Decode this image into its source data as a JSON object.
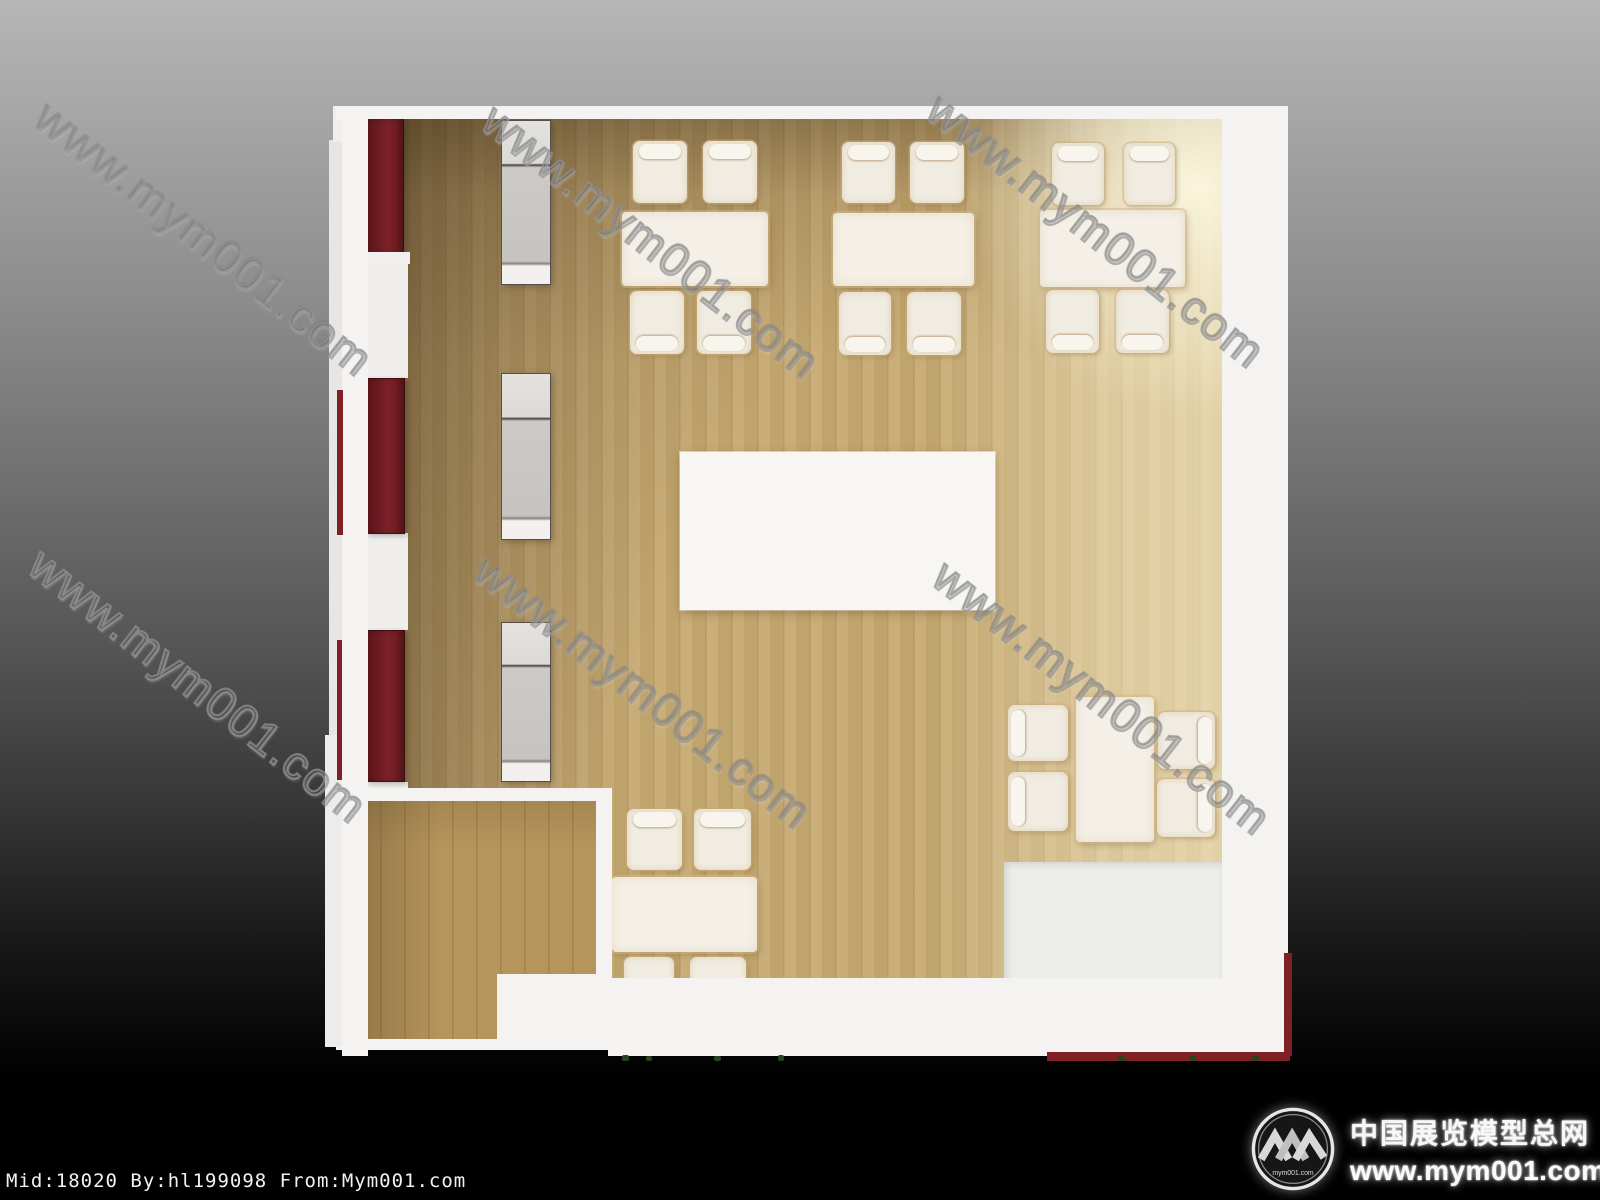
{
  "scene": {
    "colors": {
      "background_top": "#b6b6b6",
      "background_bottom": "#000000",
      "wall_white": "#f4f3f1",
      "floor_wood": "#c6aa72",
      "floor_wood_dark": "#7a5f3e",
      "floor_wood_light": "#ecd9a4",
      "small_room_floor": "#b5955c",
      "cabinet_red": "#7b2127",
      "display_case_gray": "#c9c7c3",
      "furniture_white": "#f1ece2",
      "platform_gray": "#ececea",
      "watermark_gray": "#949494"
    }
  },
  "watermark": {
    "text": "www.mym001.com",
    "angle_deg": 38,
    "positions": [
      {
        "x": 58,
        "y": 90
      },
      {
        "x": 505,
        "y": 93
      },
      {
        "x": 950,
        "y": 82
      },
      {
        "x": 52,
        "y": 537
      },
      {
        "x": 497,
        "y": 543
      },
      {
        "x": 956,
        "y": 549
      }
    ]
  },
  "branding": {
    "logo_badge_text": "mym001.com",
    "site_name_cn": "中国展览模型总网",
    "site_url": "www.mym001.com"
  },
  "footer": {
    "credit": "Mid:18020 By:hl199098 From:Mym001.com"
  },
  "floorplan": {
    "floor": {
      "x": 367,
      "y": 118,
      "w": 855,
      "h": 864
    },
    "walls": [
      {
        "name": "outer-left-strip-1",
        "x": 329,
        "y": 140,
        "w": 13,
        "h": 630,
        "bg": "#e7e6e4"
      },
      {
        "name": "outer-left-strip-2",
        "x": 325,
        "y": 735,
        "w": 17,
        "h": 312,
        "bg": "#edecea"
      },
      {
        "name": "outer-left-step-top",
        "x": 333,
        "y": 106,
        "w": 12,
        "h": 36,
        "bg": "#f0efed"
      },
      {
        "name": "left",
        "x": 342,
        "y": 106,
        "w": 26,
        "h": 950
      },
      {
        "name": "top",
        "x": 336,
        "y": 106,
        "w": 952,
        "h": 13
      },
      {
        "name": "right",
        "x": 1222,
        "y": 106,
        "w": 66,
        "h": 950
      },
      {
        "name": "bottom",
        "x": 608,
        "y": 978,
        "w": 680,
        "h": 78
      }
    ],
    "red_cabinets": [
      {
        "x": 367,
        "y": 118,
        "w": 37,
        "h": 136
      },
      {
        "x": 367,
        "y": 378,
        "w": 38,
        "h": 156
      },
      {
        "x": 367,
        "y": 630,
        "w": 38,
        "h": 152
      }
    ],
    "cabinet_base": {
      "x": 362,
      "y": 252,
      "w": 48,
      "h": 12
    },
    "wall_base_fills": [
      {
        "x": 362,
        "y": 264,
        "w": 46,
        "h": 114
      },
      {
        "x": 362,
        "y": 533,
        "w": 46,
        "h": 97
      },
      {
        "x": 362,
        "y": 782,
        "w": 46,
        "h": 8
      }
    ],
    "display_cases": [
      {
        "x": 501,
        "y": 120,
        "w": 48,
        "h": 163
      },
      {
        "x": 501,
        "y": 373,
        "w": 48,
        "h": 165
      },
      {
        "x": 501,
        "y": 622,
        "w": 48,
        "h": 158
      }
    ],
    "dining_sets": [
      {
        "table": {
          "x": 622,
          "y": 212,
          "w": 146,
          "h": 74
        },
        "chairs": [
          {
            "x": 633,
            "y": 141,
            "w": 54,
            "h": 62,
            "head": "top"
          },
          {
            "x": 703,
            "y": 141,
            "w": 54,
            "h": 62,
            "head": "top"
          },
          {
            "x": 630,
            "y": 291,
            "w": 54,
            "h": 63,
            "head": "bottom"
          },
          {
            "x": 697,
            "y": 291,
            "w": 54,
            "h": 63,
            "head": "bottom"
          }
        ]
      },
      {
        "table": {
          "x": 833,
          "y": 213,
          "w": 141,
          "h": 73
        },
        "chairs": [
          {
            "x": 842,
            "y": 142,
            "w": 53,
            "h": 61,
            "head": "top"
          },
          {
            "x": 910,
            "y": 142,
            "w": 54,
            "h": 61,
            "head": "top"
          },
          {
            "x": 839,
            "y": 292,
            "w": 52,
            "h": 63,
            "head": "bottom"
          },
          {
            "x": 907,
            "y": 292,
            "w": 54,
            "h": 63,
            "head": "bottom"
          }
        ]
      },
      {
        "table": {
          "x": 1040,
          "y": 210,
          "w": 145,
          "h": 77
        },
        "chairs": [
          {
            "x": 1052,
            "y": 143,
            "w": 52,
            "h": 62,
            "head": "top"
          },
          {
            "x": 1124,
            "y": 143,
            "w": 51,
            "h": 62,
            "head": "top"
          },
          {
            "x": 1046,
            "y": 290,
            "w": 53,
            "h": 63,
            "head": "bottom"
          },
          {
            "x": 1116,
            "y": 290,
            "w": 53,
            "h": 63,
            "head": "bottom"
          }
        ]
      },
      {
        "table": {
          "x": 612,
          "y": 877,
          "w": 145,
          "h": 75
        },
        "chairs": [
          {
            "x": 627,
            "y": 809,
            "w": 55,
            "h": 61,
            "head": "top"
          },
          {
            "x": 694,
            "y": 809,
            "w": 57,
            "h": 61,
            "head": "top"
          },
          {
            "x": 624,
            "y": 957,
            "w": 50,
            "h": 60,
            "head": "bottom"
          },
          {
            "x": 690,
            "y": 957,
            "w": 56,
            "h": 60,
            "head": "bottom"
          }
        ]
      },
      {
        "table": {
          "x": 1076,
          "y": 697,
          "w": 78,
          "h": 145
        },
        "chairs": [
          {
            "x": 1008,
            "y": 705,
            "w": 60,
            "h": 56,
            "head": "left"
          },
          {
            "x": 1008,
            "y": 772,
            "w": 60,
            "h": 59,
            "head": "left"
          },
          {
            "x": 1158,
            "y": 712,
            "w": 57,
            "h": 57,
            "head": "right"
          },
          {
            "x": 1157,
            "y": 779,
            "w": 58,
            "h": 58,
            "head": "right"
          }
        ]
      }
    ],
    "center_block": {
      "x": 680,
      "y": 452,
      "w": 315,
      "h": 158
    },
    "platform": {
      "x": 1004,
      "y": 862,
      "w": 219,
      "h": 124
    },
    "small_room": {
      "outer": {
        "x": 336,
        "y": 788,
        "w": 276,
        "h": 262
      },
      "floor": {
        "x": 356,
        "y": 801,
        "w": 240,
        "h": 238
      },
      "notch": {
        "x": 497,
        "y": 974,
        "w": 115,
        "h": 76
      }
    },
    "red_trims": [
      {
        "x": 337,
        "y": 390,
        "w": 6,
        "h": 145
      },
      {
        "x": 337,
        "y": 640,
        "w": 5,
        "h": 140
      },
      {
        "x": 1047,
        "y": 1052,
        "w": 243,
        "h": 9
      },
      {
        "x": 1284,
        "y": 953,
        "w": 8,
        "h": 103
      }
    ],
    "plants": [
      {
        "x": 622,
        "y": 1055,
        "w": 7,
        "h": 6
      },
      {
        "x": 646,
        "y": 1056,
        "w": 6,
        "h": 5
      },
      {
        "x": 714,
        "y": 1056,
        "w": 7,
        "h": 5
      },
      {
        "x": 778,
        "y": 1055,
        "w": 6,
        "h": 6
      },
      {
        "x": 1118,
        "y": 1056,
        "w": 7,
        "h": 5
      },
      {
        "x": 1190,
        "y": 1055,
        "w": 6,
        "h": 6
      },
      {
        "x": 1252,
        "y": 1056,
        "w": 7,
        "h": 5
      }
    ]
  }
}
